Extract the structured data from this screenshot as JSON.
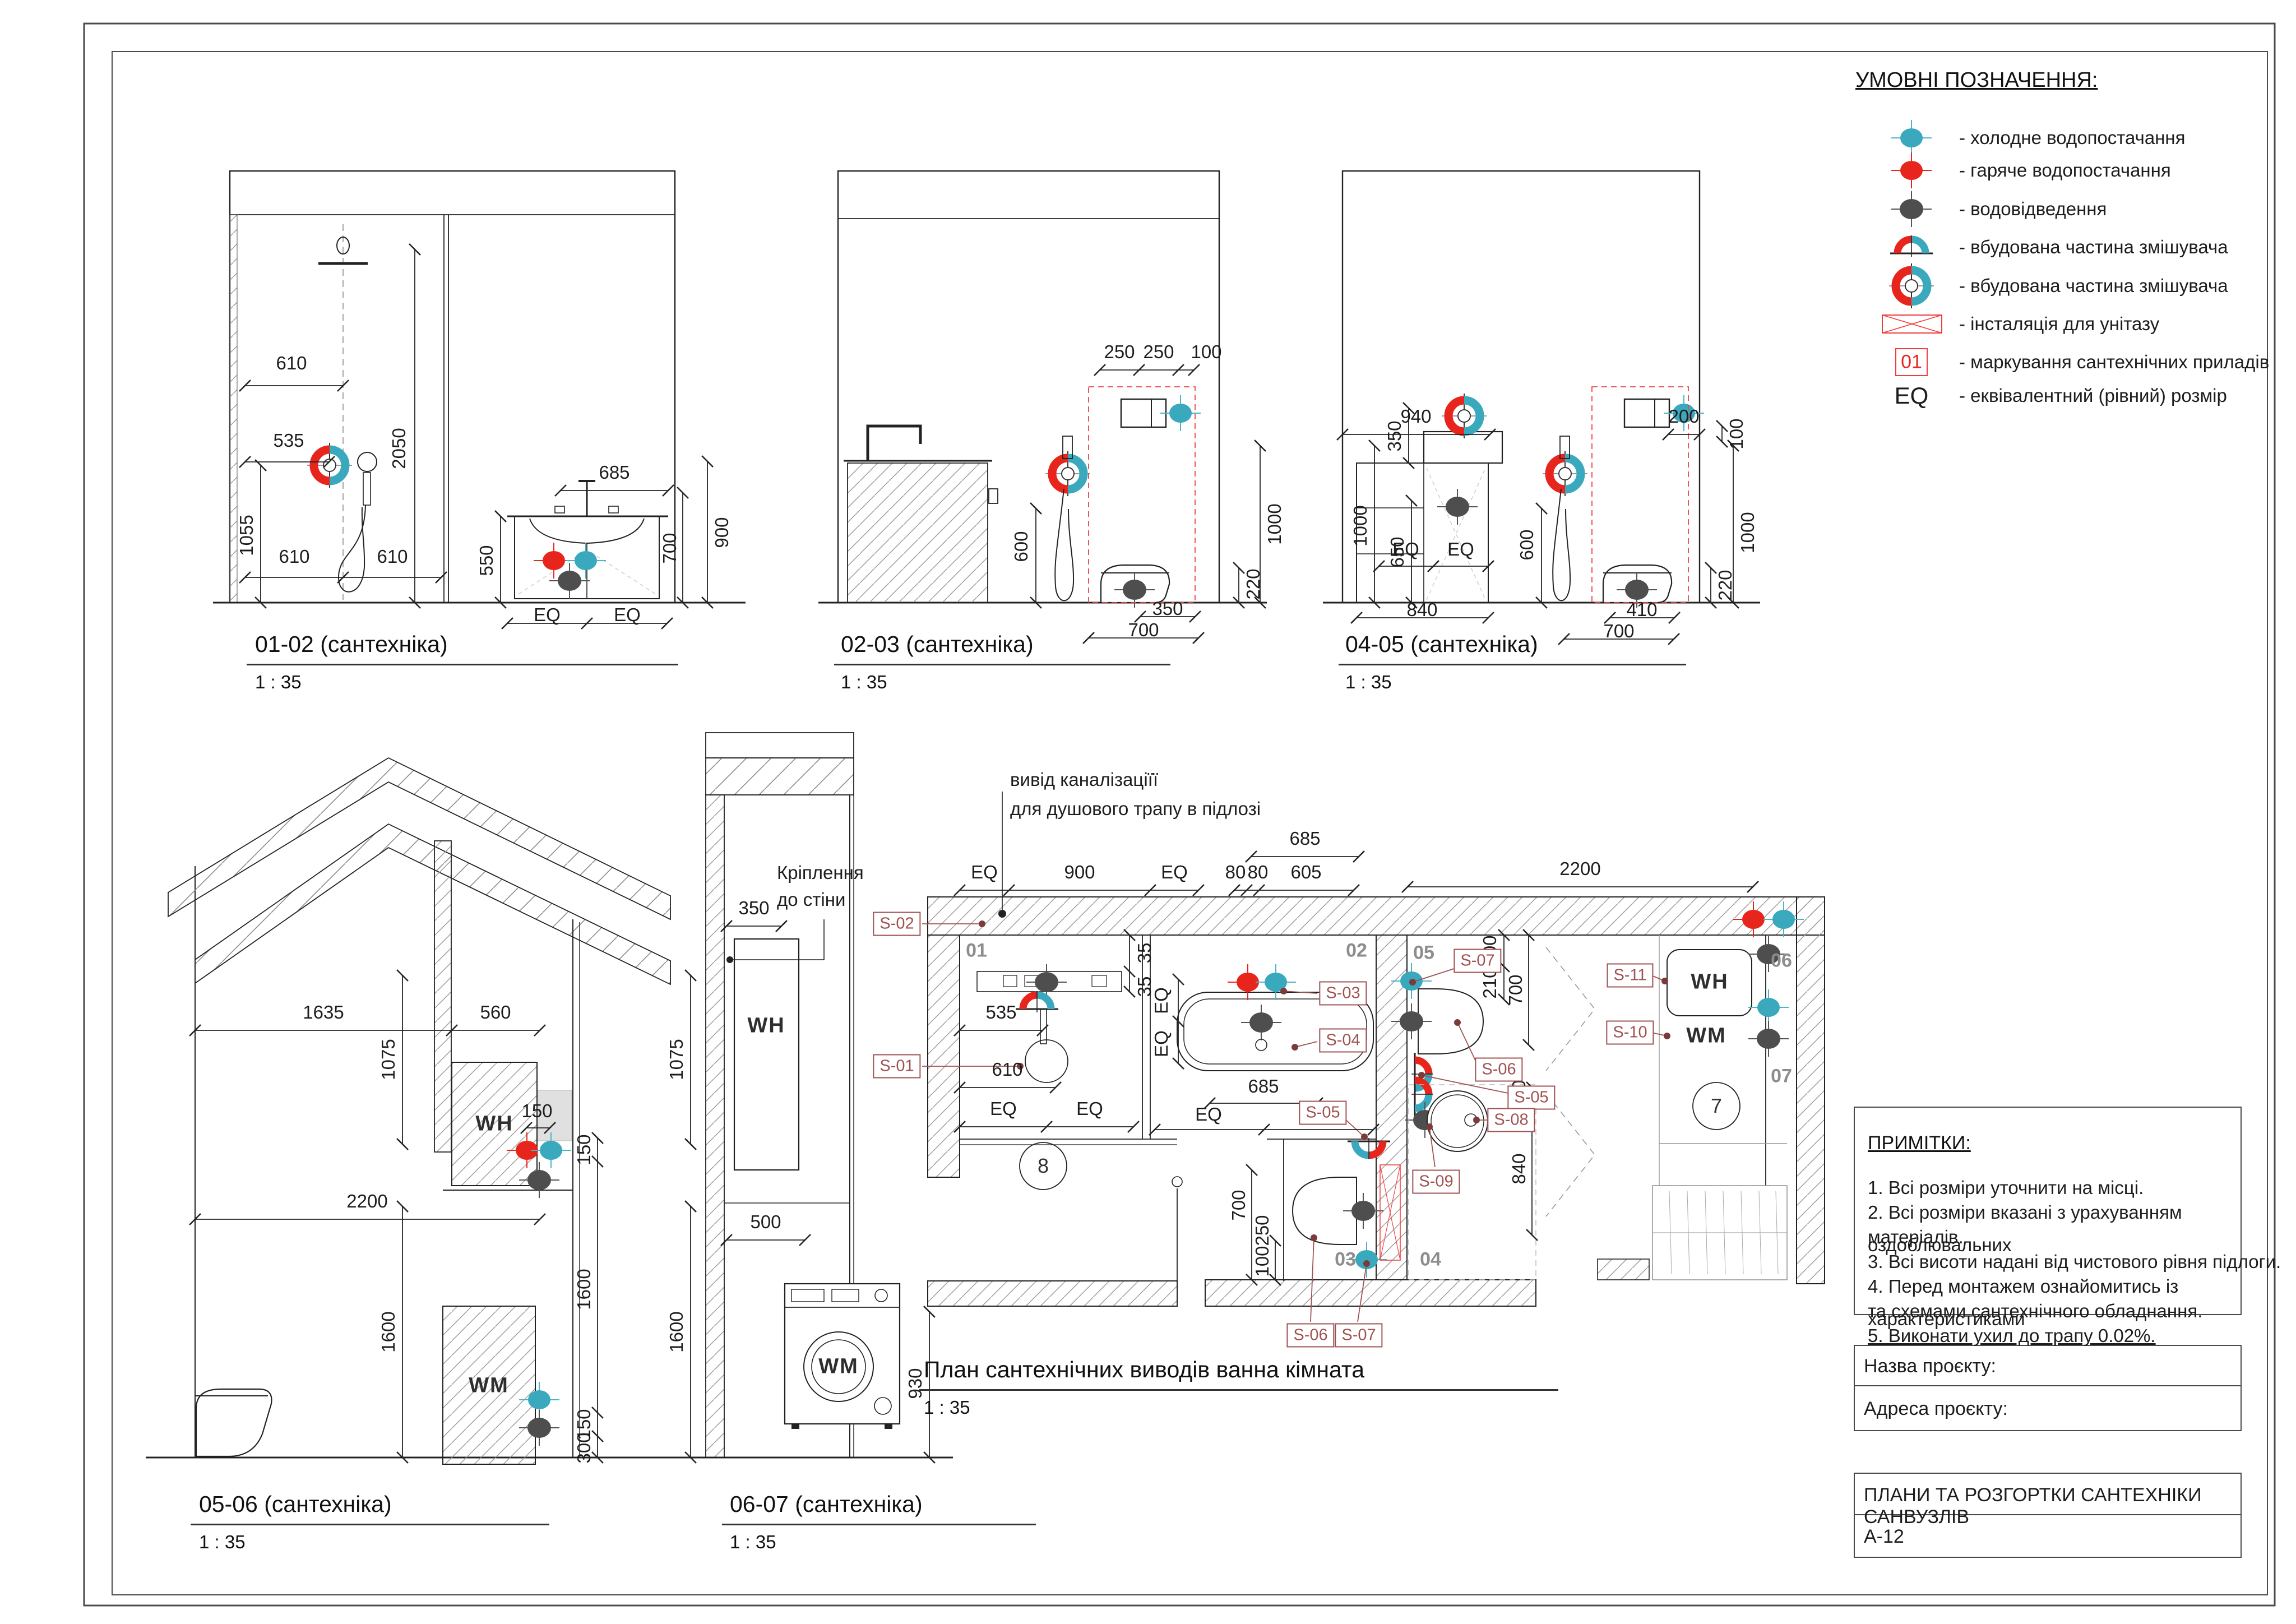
{
  "legend": {
    "title": "УМОВНІ ПОЗНАЧЕННЯ:",
    "items": [
      {
        "icon": "cold-water-marker",
        "label": "- холодне водопостачання"
      },
      {
        "icon": "hot-water-marker",
        "label": "- гаряче водопостачання"
      },
      {
        "icon": "drain-marker",
        "label": "- водовідведення"
      },
      {
        "icon": "mixer-built-in-half-marker",
        "label": "- вбудована частина змішувача"
      },
      {
        "icon": "mixer-built-in-ring-marker",
        "label": "- вбудована частина змішувача"
      },
      {
        "icon": "wc-installation-marker",
        "label": "- інсталяція для унітазу"
      },
      {
        "icon": "fixture-tag-marker",
        "badge": "01",
        "label": "- маркування сантехнічних приладів"
      },
      {
        "icon": "eq-marker",
        "symbol": "EQ",
        "label": "- еквівалентний (рівний) розмір"
      }
    ]
  },
  "notes": {
    "title": "ПРИМІТКИ:",
    "line1": "1. Всі розміри уточнити на місці.",
    "line2": "2. Всі розміри вказані з урахуванням оздоблювальних",
    "line3": "матеріалів.",
    "line4": "3. Всі висоти надані від чистового рівня підлоги.",
    "line5": "4. Перед монтажем ознайомитись із характеристиками",
    "line6": "та схемами сантехнічного обладнання.",
    "line7": "5. Виконати ухил до трапу 0.02%."
  },
  "titleblock": {
    "project_name_label": "Назва проєкту:",
    "project_address_label": "Адреса проєкту:",
    "sheet_title": "ПЛАНИ ТА РОЗГОРТКИ САНТЕХНІКИ САНВУЗЛІВ",
    "sheet_number": "А-12"
  },
  "views": {
    "v0102": {
      "title": "01-02 (сантехніка)",
      "scale": "1 : 35",
      "dims": [
        "610",
        "535",
        "2050",
        "610",
        "610",
        "1055",
        "685",
        "550",
        "700",
        "900",
        "EQ",
        "EQ"
      ]
    },
    "v0203": {
      "title": "02-03 (сантехніка)",
      "scale": "1 : 35",
      "dims": [
        "250",
        "250",
        "100",
        "1000",
        "600",
        "220",
        "350",
        "700"
      ]
    },
    "v0405": {
      "title": "04-05 (сантехніка)",
      "scale": "1 : 35",
      "dims": [
        "940",
        "200",
        "100",
        "1000",
        "220",
        "350",
        "1000",
        "650",
        "EQ",
        "EQ",
        "600",
        "840",
        "410",
        "700"
      ]
    },
    "v0506": {
      "title": "05-06 (сантехніка)",
      "scale": "1 : 35",
      "wh": "WH",
      "wm": "WM",
      "dims": [
        "1635",
        "560",
        "1075",
        "150",
        "150",
        "2200",
        "1600",
        "1600",
        "150",
        "300"
      ]
    },
    "v0607": {
      "title": "06-07 (сантехніка)",
      "scale": "1 : 35",
      "wh": "WH",
      "wm": "WM",
      "ann1": "Кріплення",
      "ann2": "до стіни",
      "dims": [
        "350",
        "1075",
        "500",
        "930",
        "1600"
      ]
    },
    "plan": {
      "title": "План сантехнічних виводів ванна кімната",
      "scale": "1 : 35",
      "ann1": "вивід каналізаціїї",
      "ann2": "для душового трапу в підлозі",
      "wh": "WH",
      "wm": "WM",
      "rooms": [
        "01",
        "02",
        "03",
        "04",
        "05",
        "06",
        "07"
      ],
      "circles": [
        "8",
        "7"
      ],
      "tags": [
        "S-01",
        "S-02",
        "S-03",
        "S-04",
        "S-05",
        "S-05",
        "S-06",
        "S-06",
        "S-07",
        "S-07",
        "S-08",
        "S-09",
        "S-10",
        "S-11"
      ],
      "dims": [
        "685",
        "EQ",
        "900",
        "EQ",
        "80",
        "80",
        "605",
        "2200",
        "35",
        "35",
        "535",
        "610",
        "EQ",
        "EQ",
        "EQ",
        "EQ",
        "685",
        "EQ",
        "EQ",
        "200",
        "210",
        "700",
        "700",
        "250",
        "100",
        "100",
        "840"
      ]
    }
  },
  "colors": {
    "cold": "#3aa9bd",
    "hot": "#e8251d",
    "drain": "#4e4e4e",
    "tag": "#a05252",
    "install": "#ef4444"
  }
}
